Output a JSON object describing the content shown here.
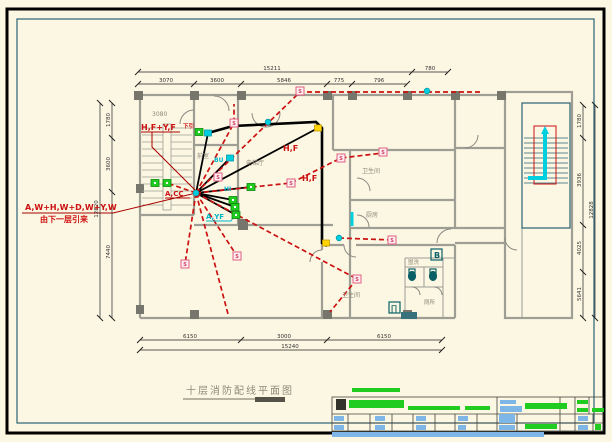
{
  "colors": {
    "bg": "#FBF7E3",
    "wall": "#9E9E94",
    "column": "#76766C",
    "teal": "#2A6274",
    "red": "#CC1111",
    "darkred": "#AA0000",
    "cyan": "#00CFE0",
    "green": "#1FCC1F",
    "blue": "#7EB6E8",
    "pink": "#E06080",
    "yellow": "#FFD400",
    "grey_text": "#8F8A7A",
    "dim_text": "#333333"
  },
  "title": {
    "text": "十层消防配线平面图"
  },
  "labels": {
    "feeder_line1": "A,W+H,W+D,W+Y,W",
    "feeder_line2": "由下一层引来",
    "riser_top": "H,F+Y,F",
    "riser_top_suffix": "下引",
    "stair_num": "3080",
    "acc": "A,CC",
    "hf_1": "H,F",
    "hf_2": "H,F",
    "ayf": "A,YF",
    "hi": "HI",
    "bu": "BU",
    "b_box": "B",
    "pi_box": "∏",
    "detector_glyph": "S"
  },
  "rooms": {
    "vestibule": "前室",
    "elevator_hall": "电梯厅",
    "bathroom": "卫生间",
    "kitchen": "厨房",
    "bathroom2": "卫生间",
    "washroom": "盥洗",
    "wc": "厕所"
  },
  "dims": {
    "chains": [
      {
        "name": "top-total",
        "orient": "h",
        "pos": 72,
        "from": 138,
        "to": 448,
        "ticks": [
          138,
          412,
          448
        ],
        "labels": [
          {
            "t": "15211",
            "at": 272
          },
          {
            "t": "780",
            "at": 430
          }
        ]
      },
      {
        "name": "top-segments",
        "orient": "h",
        "pos": 84,
        "from": 138,
        "to": 407,
        "ticks": [
          138,
          194,
          241,
          327,
          352,
          407
        ],
        "labels": [
          {
            "t": "3070",
            "at": 166
          },
          {
            "t": "3600",
            "at": 217
          },
          {
            "t": "5846",
            "at": 284
          },
          {
            "t": "775",
            "at": 339
          },
          {
            "t": "796",
            "at": 379
          }
        ]
      },
      {
        "name": "bottom-segments",
        "orient": "h",
        "pos": 340,
        "from": 140,
        "to": 442,
        "ticks": [
          140,
          241,
          327,
          442
        ],
        "labels": [
          {
            "t": "6150",
            "at": 190
          },
          {
            "t": "3000",
            "at": 284
          },
          {
            "t": "6150",
            "at": 384
          }
        ]
      },
      {
        "name": "bottom-total",
        "orient": "h",
        "pos": 350,
        "from": 140,
        "to": 442,
        "ticks": [
          140,
          442
        ],
        "labels": [
          {
            "t": "15240",
            "at": 290
          }
        ]
      },
      {
        "name": "left-segments",
        "orient": "v",
        "pos": 112,
        "from": 103,
        "to": 318,
        "ticks": [
          103,
          138,
          192,
          318
        ],
        "labels": [
          {
            "t": "1780",
            "at": 120
          },
          {
            "t": "3600",
            "at": 164
          },
          {
            "t": "7440",
            "at": 252
          }
        ]
      },
      {
        "name": "left-total",
        "orient": "v",
        "pos": 100,
        "from": 103,
        "to": 318,
        "ticks": [
          103,
          318
        ],
        "labels": [
          {
            "t": "12820",
            "at": 209
          }
        ]
      },
      {
        "name": "right-segments",
        "orient": "v",
        "pos": 583,
        "from": 105,
        "to": 318,
        "ticks": [
          105,
          138,
          225,
          272,
          318
        ],
        "labels": [
          {
            "t": "1780",
            "at": 121
          },
          {
            "t": "3936",
            "at": 180
          },
          {
            "t": "4025",
            "at": 248
          },
          {
            "t": "5641",
            "at": 294
          }
        ]
      },
      {
        "name": "right-total",
        "orient": "v",
        "pos": 595,
        "from": 105,
        "to": 318,
        "ticks": [
          105,
          318
        ],
        "labels": [
          {
            "t": "12828",
            "at": 210
          }
        ]
      }
    ]
  },
  "plan": {
    "smoke_detectors": [
      [
        234,
        123
      ],
      [
        300,
        91
      ],
      [
        341,
        158
      ],
      [
        383,
        152
      ],
      [
        291,
        183
      ],
      [
        218,
        177
      ],
      [
        185,
        264
      ],
      [
        237,
        256
      ],
      [
        357,
        279
      ],
      [
        392,
        240
      ]
    ],
    "green_boxes": [
      [
        155,
        183
      ],
      [
        167,
        183
      ],
      [
        199,
        132
      ],
      [
        233,
        200
      ],
      [
        235,
        207
      ],
      [
        236,
        215
      ],
      [
        251,
        187
      ]
    ],
    "cyan_dots": [
      [
        196,
        193
      ],
      [
        268,
        122
      ],
      [
        427,
        91
      ],
      [
        339,
        238
      ]
    ],
    "cyan_boxes": [
      [
        208,
        133
      ],
      [
        230,
        158
      ]
    ],
    "yellow_nodes": [
      [
        318,
        128
      ],
      [
        326,
        243
      ]
    ]
  }
}
